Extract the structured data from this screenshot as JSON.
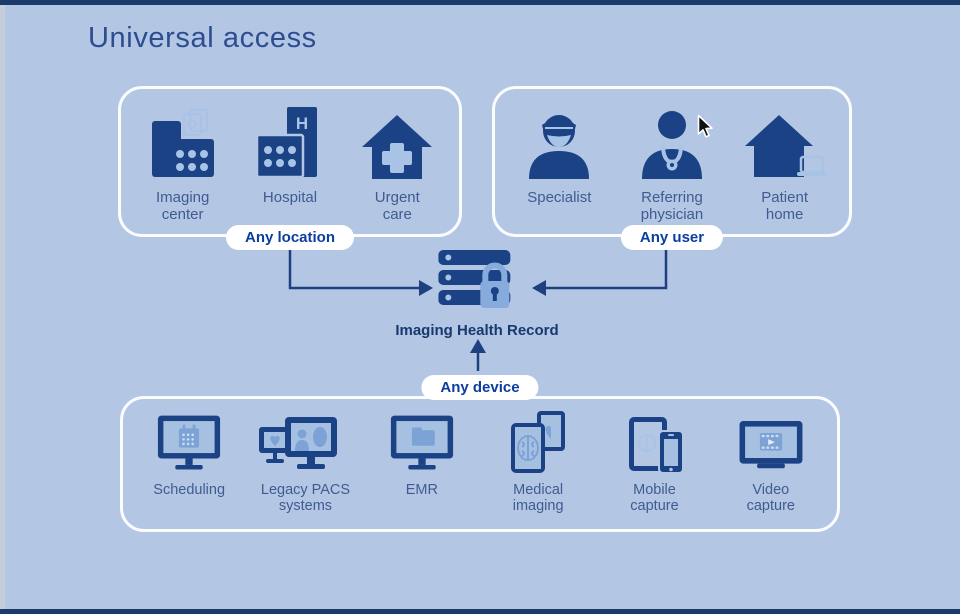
{
  "title": "Universal access",
  "groups": {
    "location": {
      "pill": "Any location",
      "items": [
        {
          "icon": "imaging-center-icon",
          "label": "Imaging\ncenter"
        },
        {
          "icon": "hospital-icon",
          "label": "Hospital"
        },
        {
          "icon": "urgent-care-icon",
          "label": "Urgent\ncare"
        }
      ]
    },
    "user": {
      "pill": "Any user",
      "items": [
        {
          "icon": "specialist-icon",
          "label": "Specialist"
        },
        {
          "icon": "referring-physician-icon",
          "label": "Referring\nphysician"
        },
        {
          "icon": "patient-home-icon",
          "label": "Patient\nhome"
        }
      ]
    },
    "device": {
      "pill": "Any device",
      "items": [
        {
          "icon": "scheduling-icon",
          "label": "Scheduling"
        },
        {
          "icon": "legacy-pacs-icon",
          "label": "Legacy PACS\nsystems"
        },
        {
          "icon": "emr-icon",
          "label": "EMR"
        },
        {
          "icon": "medical-imaging-icon",
          "label": "Medical\nimaging"
        },
        {
          "icon": "mobile-capture-icon",
          "label": "Mobile\ncapture"
        },
        {
          "icon": "video-capture-icon",
          "label": "Video\ncapture"
        }
      ]
    }
  },
  "center": {
    "icon": "secure-server-icon",
    "label": "Imaging Health Record"
  },
  "colors": {
    "background": "#b3c6e4",
    "icon_navy": "#1a4284",
    "edge_bar_navy": "#1d3a6d",
    "pill_text": "#0b3ea0",
    "label_text": "#3f5c90",
    "accent_light": "#a9c3e6",
    "accent_medium": "#7ca2d6",
    "pill_background": "#ffffff"
  }
}
